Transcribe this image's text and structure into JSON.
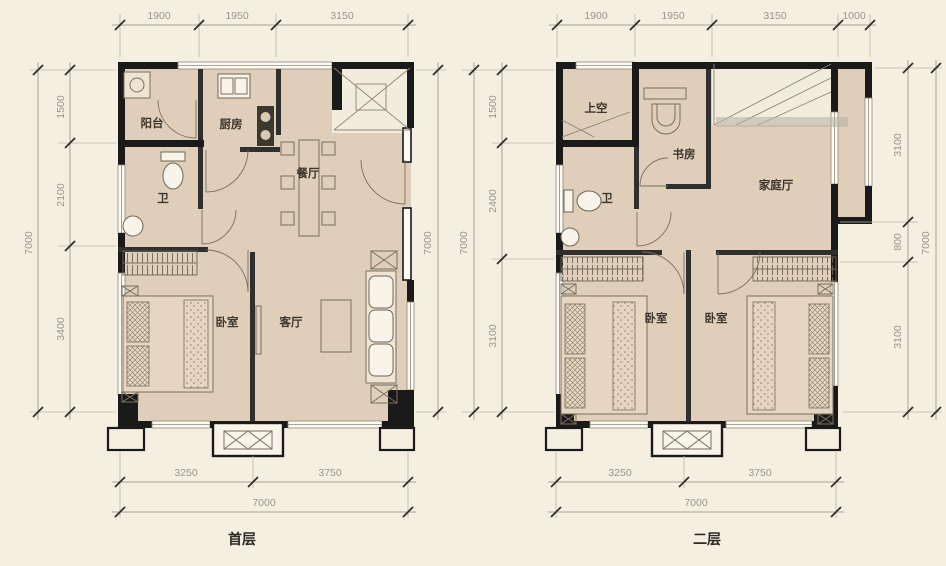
{
  "page": {
    "background": "#f5efe2"
  },
  "palette": {
    "room_fill": "#dfceba",
    "stair_fill": "#f2ecdf",
    "wall": "#1a1a1a",
    "dimension_line": "#aaa294",
    "dimension_text": "#9c9489",
    "label_text": "#3c362c"
  },
  "first_floor": {
    "title": "首层",
    "rooms": {
      "balcony": "阳台",
      "kitchen": "厨房",
      "dining": "餐厅",
      "bath": "卫",
      "bedroom": "卧室",
      "living": "客厅"
    },
    "dims": {
      "top": [
        "1900",
        "1950",
        "3150"
      ],
      "left_total": "7000",
      "left_segments": [
        "1500",
        "2100",
        "3400"
      ],
      "right_total": "7000",
      "bottom_segments": [
        "3250",
        "3750"
      ],
      "bottom_total": "7000"
    }
  },
  "second_floor": {
    "title": "二层",
    "rooms": {
      "void": "上空",
      "study": "书房",
      "family": "家庭厅",
      "bath": "卫",
      "bedroom_left": "卧室",
      "bedroom_right": "卧室"
    },
    "dims": {
      "top": [
        "1900",
        "1950",
        "3150",
        "1000"
      ],
      "left_total": "7000",
      "left_segments": [
        "1500",
        "2400",
        "3100"
      ],
      "right_segments": [
        "3100",
        "800",
        "3100"
      ],
      "right_total": "7000",
      "bottom_segments": [
        "3250",
        "3750"
      ],
      "bottom_total": "7000"
    }
  }
}
